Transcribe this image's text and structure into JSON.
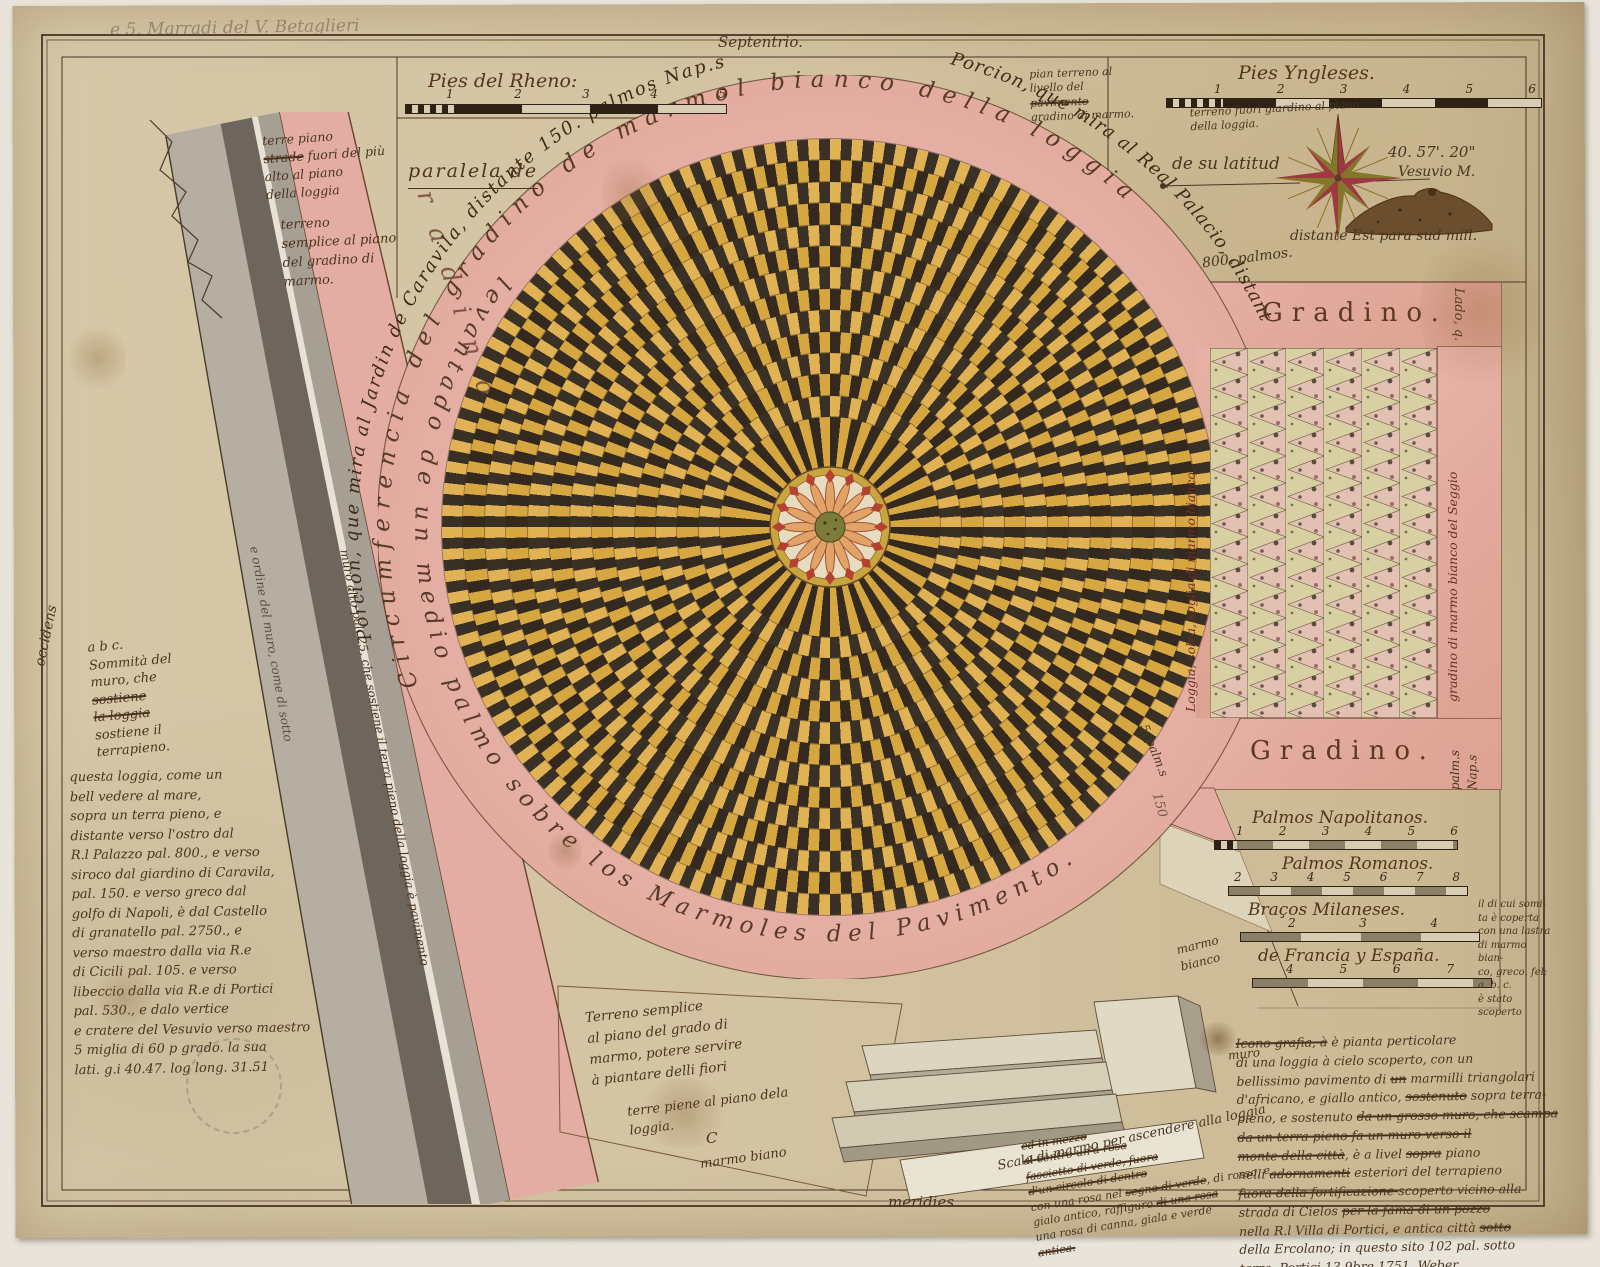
{
  "colors": {
    "paper": "#d2c2a0",
    "pink": "#e3aca1",
    "gold": "#d6a640",
    "gold_light": "#e0b254",
    "dark_tess": "#33291f",
    "dark_tess2": "#3a3126",
    "ink": "#4a3420",
    "panel_cream": "#d8d0a2",
    "panel_pink": "#e2c0b2",
    "compass_green": "#837729",
    "compass_red": "#9c3a40"
  },
  "header": {
    "inscription": "e 5. Marradi del V. Betaglieri",
    "north": "Septentrio."
  },
  "compass": {
    "lat_label": "de su latitud",
    "lat_value": "40. 57'. 20\"",
    "vesuvio": "Vesuvio M.",
    "distance": "distante Est para sud mill.",
    "palmos": "800. palmos."
  },
  "ring": {
    "outer_left": "Porcion, que mira al Jardin de Caravila, distante 150. palmos Nap.s",
    "outer_right": "Porcion, que mira al Real Palacio, distante",
    "upper": "Circumferencia del gradino de marmol bianco della loggia",
    "lower": "levantado de un medio palmo sobre los Marmoles del Pavimento.",
    "road_letters": "radino",
    "gap_number": "150"
  },
  "bands": {
    "gradino_top": "Gradino.",
    "gradino_bottom": "Gradino.",
    "lado": "Lado, q.",
    "palm_nap": "palm.s Nap.s",
    "cinque_palm": "5. palm.s",
    "loggia_strip": "Loggia, solea, soglia di marmo bianco.",
    "gradino_strip": "gradino di marmo bianco del Seggio"
  },
  "scales": {
    "rheno": {
      "label": "Pies del Rheno:",
      "ticks": [
        "1",
        "2",
        "3",
        "4",
        "5"
      ]
    },
    "yngleses": {
      "label": "Pies Yngleses.",
      "ticks": [
        "1",
        "2",
        "3",
        "4",
        "5",
        "6"
      ]
    },
    "right": [
      {
        "label": "Palmos Napolitanos.",
        "ticks": [
          "1",
          "2",
          "3",
          "4",
          "5",
          "6"
        ]
      },
      {
        "label": "Palmos Romanos.",
        "ticks": [
          "2",
          "3",
          "4",
          "5",
          "6",
          "7",
          "8"
        ]
      },
      {
        "label": "Braços Milaneses.",
        "ticks": [
          "2",
          "3",
          "4"
        ]
      },
      {
        "label": "de Francia y España.",
        "ticks": [
          "4",
          "5",
          "6",
          "7"
        ]
      }
    ]
  },
  "labels": {
    "paralela": "paralela de",
    "occidens": "occidens",
    "meridies": "meridies",
    "muro": "muro",
    "c_mark": "C",
    "marmo_biano": "marmo biano",
    "marmo_bianco": "marmo bianco",
    "scala": "Scala di marmo per ascendere alla loggia"
  },
  "notes": {
    "terre_piano": [
      {
        "t": "terre piano",
        "br": 1
      },
      {
        "t": "strade",
        "s": 1
      },
      {
        "t": " fuori del più",
        "br": 1
      },
      {
        "t": "alto al piano",
        "br": 1
      },
      {
        "t": "della loggia"
      }
    ],
    "terreno_semplice": [
      "terreno",
      "semplice al piano",
      "del gradino di",
      "marmo."
    ],
    "pian_terreno": [
      {
        "t": "pian terreno al",
        "br": 1
      },
      {
        "t": "livello del",
        "br": 1
      },
      {
        "t": "pavimento",
        "s": 1,
        "br": 1
      },
      {
        "t": "gradino di marmo."
      }
    ],
    "terreno_fuori": [
      "terreno fuori giardino al piano",
      "della loggia."
    ],
    "abc": [
      {
        "t": "a b c.",
        "br": 1
      },
      {
        "t": "Sommità del",
        "br": 1
      },
      {
        "t": "muro, che",
        "br": 1
      },
      {
        "t": "sostiene",
        "s": 1,
        "br": 1
      },
      {
        "t": "la loggia",
        "s": 1,
        "br": 1
      },
      {
        "t": "sostiene il",
        "br": 1
      },
      {
        "t": "terrapieno."
      }
    ],
    "left_para": [
      "questa loggia, come un",
      "bell vedere al mare,",
      "sopra un terra pieno, e",
      "distante verso l'ostro dal",
      "R.l Palazzo pal. 800., e verso",
      "siroco dal giardino di Caravila,",
      "pal. 150. e verso greco dal",
      "golfo di Napoli, è dal Castello",
      "di granatello pal. 2750., e",
      "verso maestro dalla via R.e",
      "di Cicili pal. 105. e verso",
      "libeccio dalla via R.e di Portici",
      "pal. 530., e dalo vertice",
      "e cratere del Vesuvio verso maestro",
      "5 miglia di 60 p grado. la sua",
      "lati. g.i 40.47. log long. 31.51"
    ],
    "road1": "muro alto pal. 25. che sostiene il terra pieno della loggia è pavimento",
    "road2": "e ordine del muro, come di sotto",
    "bottom_center": [
      "Terreno semplice",
      "al piano del grado di",
      "marmo, potere servire",
      "à piantare delli fiori"
    ],
    "terre_piene": [
      "terre piene al piano dela",
      "loggia."
    ],
    "steps_note": [
      {
        "t": "ed in mezzo",
        "s": 1,
        "br": 1
      },
      {
        "t": "al centro un'a rosa",
        "s": 1,
        "br": 1
      },
      {
        "t": "fascietto di verde, fuora",
        "s": 1,
        "br": 1
      },
      {
        "t": "d'un circolo di dentro",
        "s": 1,
        "br": 1
      },
      {
        "t": "con una rosa nel "
      },
      {
        "t": "segno di verde",
        "s": 1
      },
      {
        "t": ", di rosso, e",
        "br": 1
      },
      {
        "t": "gialo antico, raffiguro "
      },
      {
        "t": "di una rosa",
        "s": 1,
        "br": 1
      },
      {
        "t": "una rosa di canna, giala e verde",
        "br": 1
      },
      {
        "t": "antica.",
        "s": 1
      }
    ],
    "bottom_right": [
      {
        "t": "Icono grafia, à",
        "s": 1
      },
      {
        "t": " è pianta perticolare",
        "br": 1
      },
      {
        "t": "di una loggia à cielo scoperto, con un",
        "br": 1
      },
      {
        "t": "bellissimo pavimento di "
      },
      {
        "t": "un",
        "s": 1
      },
      {
        "t": " marmilli triangolari",
        "br": 1
      },
      {
        "t": "d'africano, e giallo antico, "
      },
      {
        "t": "sostenuto",
        "s": 1
      },
      {
        "t": " sopra terra-",
        "br": 1
      },
      {
        "t": "pieno, e sostenuto "
      },
      {
        "t": "da un grosso muro, che scampa",
        "s": 1,
        "br": 1
      },
      {
        "t": "da un terra pieno fa un muro verso il",
        "s": 1,
        "br": 1
      },
      {
        "t": "monte della città",
        "s": 1
      },
      {
        "t": ", è a livel "
      },
      {
        "t": "sopra",
        "s": 1
      },
      {
        "t": " piano",
        "br": 1
      },
      {
        "t": "nelli "
      },
      {
        "t": "adornamenti",
        "s": 1
      },
      {
        "t": " esteriori del terrapieno",
        "br": 1
      },
      {
        "t": "fuora della fortificazione ",
        "s": 1
      },
      {
        "t": "scoperto vicino alla",
        "br": 1
      },
      {
        "t": "strada di Cielos "
      },
      {
        "t": "per la fama di un pozzo",
        "s": 1,
        "br": 1
      },
      {
        "t": "nella R.l Villa di Portici, e antica città "
      },
      {
        "t": "sotto",
        "s": 1,
        "br": 1
      },
      {
        "t": "della Ercolano; in questo sito 102 pal. sotto",
        "br": 1
      },
      {
        "t": "terra. Portici 13 9bre 1751. Weber.",
        "br": 1
      },
      {
        "t": "partenendo, nelle fini arrivata dal Vesuvio",
        "s": 1,
        "br": 1
      },
      {
        "t": "l'año 79 di della gia",
        "s": 1
      }
    ],
    "right_margin": [
      "il di cui somi-",
      "ta è coperta",
      "con una lastra",
      "di marmo bian-",
      "co, greco, fel:",
      "a. b. c.",
      "è stato scoperto"
    ]
  }
}
